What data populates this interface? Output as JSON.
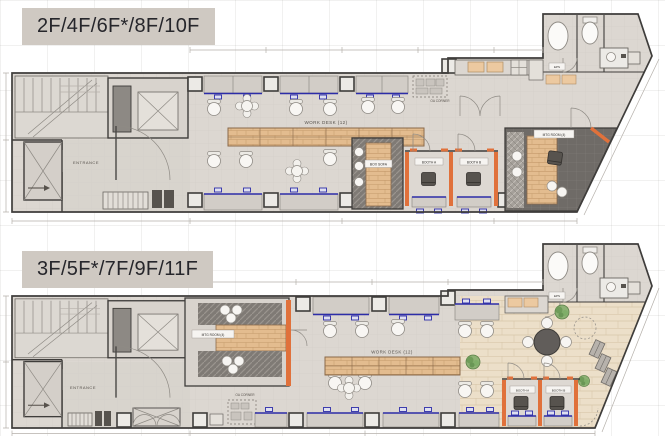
{
  "colors": {
    "accent_blue": "#2d2da8",
    "accent_orange": "#e0713b",
    "wood": "#e3bc8f",
    "floor": "#dcd7d1",
    "dark_floor": "#6f6b67",
    "wall": "#3f3d3b",
    "badge_bg": "#cfc9c2"
  },
  "plans": [
    {
      "badge": "2F/4F/6F*/8F/10F",
      "rooms": {
        "entrance": "ENTRANCE",
        "work_desk": "WORK DESK (12)",
        "box_sofa": "BOX SOFA",
        "booth_a": "BOOTH A",
        "booth_b": "BOOTH B",
        "mtg_room": "MTG ROOM (4)",
        "oa_corner": "OA CORNER",
        "eps": "EPS"
      }
    },
    {
      "badge": "3F/5F*/7F/9F/11F",
      "rooms": {
        "entrance": "ENTRANCE",
        "work_desk": "WORK DESK (12)",
        "booth_a": "BOOTH A",
        "booth_b": "BOOTH B",
        "mtg_room": "MTG ROOM (4)",
        "oa_corner": "OA CORNER",
        "eps": "EPS"
      }
    }
  ]
}
